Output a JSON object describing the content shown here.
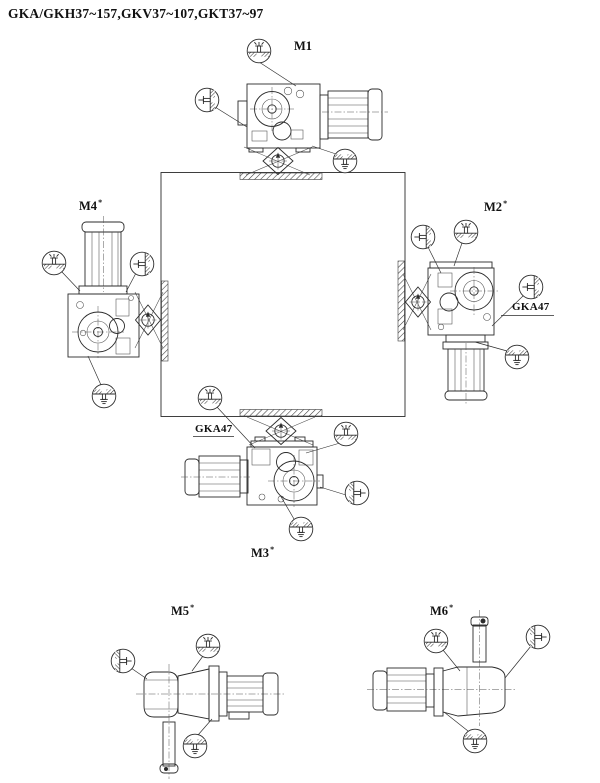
{
  "title": "GKA/GKH37~157,GKV37~107,GKT37~97",
  "colors": {
    "line": "#2b2b2b",
    "background": "#ffffff",
    "hatch": "#3a3a3a"
  },
  "views": {
    "m1": {
      "label": "M1",
      "sup": ""
    },
    "m2": {
      "label": "M2",
      "sup": "*",
      "note": "GKA47"
    },
    "m3": {
      "label": "M3",
      "sup": "*",
      "note": "GKA47"
    },
    "m4": {
      "label": "M4",
      "sup": "*"
    },
    "m5": {
      "label": "M5",
      "sup": "*"
    },
    "m6": {
      "label": "M6",
      "sup": "*"
    }
  },
  "icons": {
    "vent": "vent-plug-icon",
    "level": "oil-level-plug-icon",
    "drain": "oil-drain-plug-icon"
  }
}
